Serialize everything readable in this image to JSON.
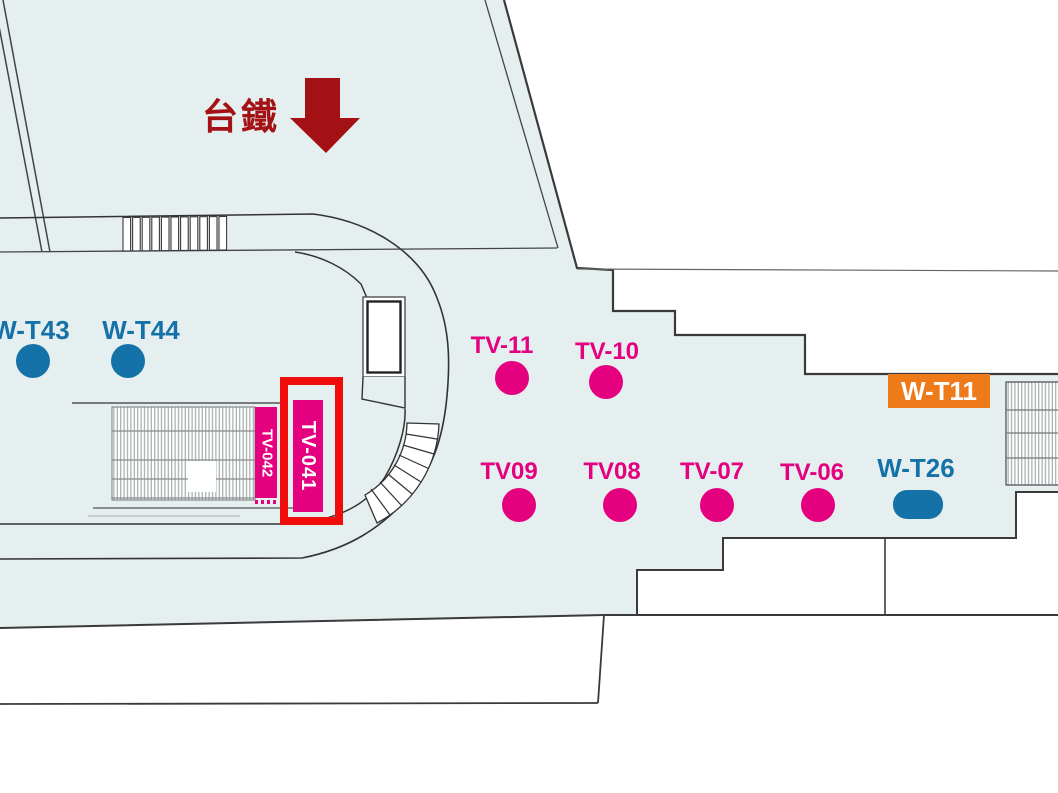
{
  "colors": {
    "floor": "#e5eff0",
    "outline": "#3a3a3a",
    "thin_line": "#555555",
    "stair_stripe": "#9aa6a6",
    "magenta": "#e4007f",
    "blue": "#1572a8",
    "orange": "#ef7a1a",
    "dark_red": "#a31114",
    "highlight_red": "#f10c0c",
    "white": "#ffffff"
  },
  "map": {
    "area_label": "台鐵",
    "area_arrow": "down-arrow",
    "highlighted_id": "TV-041",
    "markers": [
      {
        "id": "W-T43",
        "kind": "dot",
        "color": "blue"
      },
      {
        "id": "W-T44",
        "kind": "dot",
        "color": "blue"
      },
      {
        "id": "TV-041",
        "kind": "vertical-panel",
        "color": "magenta",
        "highlighted": true
      },
      {
        "id": "TV-042",
        "kind": "vertical-panel",
        "color": "magenta",
        "highlighted": false
      },
      {
        "id": "TV-11",
        "kind": "dot",
        "color": "magenta"
      },
      {
        "id": "TV-10",
        "kind": "dot",
        "color": "magenta"
      },
      {
        "id": "TV09",
        "kind": "dot",
        "color": "magenta"
      },
      {
        "id": "TV08",
        "kind": "dot",
        "color": "magenta"
      },
      {
        "id": "TV-07",
        "kind": "dot",
        "color": "magenta"
      },
      {
        "id": "TV-06",
        "kind": "dot",
        "color": "magenta"
      },
      {
        "id": "W-T26",
        "kind": "pill",
        "color": "blue"
      },
      {
        "id": "W-T11",
        "kind": "box",
        "color": "orange"
      }
    ]
  }
}
